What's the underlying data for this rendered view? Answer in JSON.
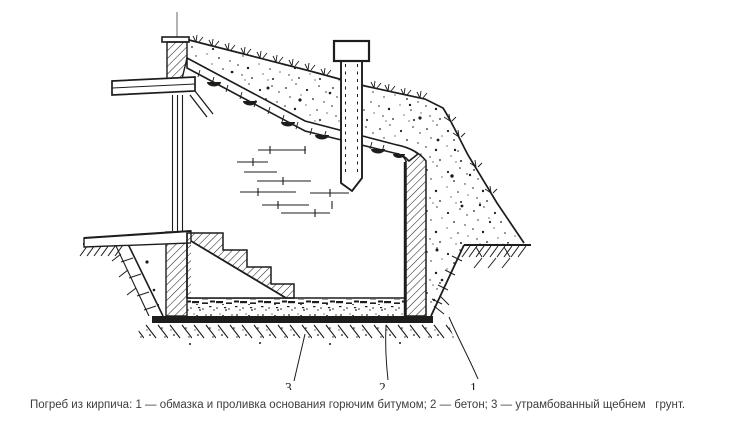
{
  "figure": {
    "type": "technical-section-drawing",
    "subject": "Погреб из кирпича (разрез)",
    "callouts": [
      {
        "number": "1",
        "meaning": "обмазка и проливка основания горючим битумом"
      },
      {
        "number": "2",
        "meaning": "бетон"
      },
      {
        "number": "3",
        "meaning": "утрамбованный щебнем грунт"
      }
    ]
  },
  "caption": {
    "text": "Погреб из кирпича: 1 — обмазка и проливка основания горючим битумом; 2 — бетон; 3 — утрамбованный щебнем   грунт."
  },
  "colors": {
    "ink": "#1d1d1b",
    "caption_text": "#3e3e3e",
    "background": "#ffffff"
  }
}
